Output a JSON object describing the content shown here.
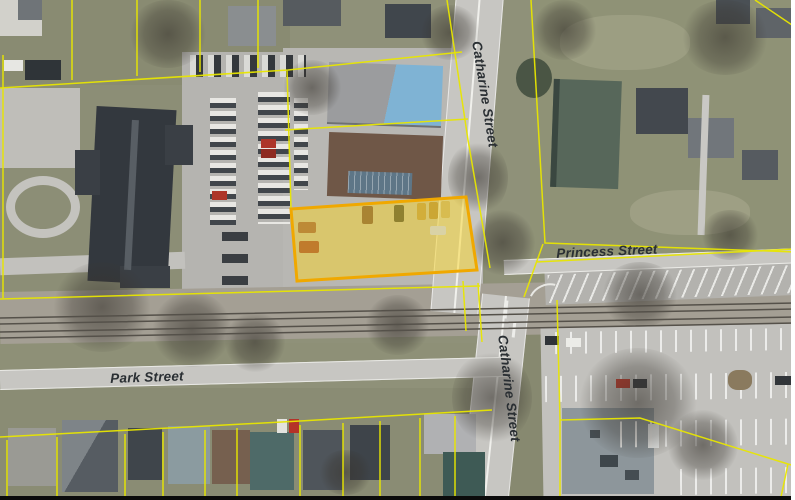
{
  "map": {
    "street_labels": {
      "catharine": "Catharine Street",
      "princess": "Princess Street",
      "park": "Park Street"
    },
    "colors": {
      "parcel_line": "#E8E600",
      "highlight_border": "#F0A800",
      "highlight_fill": "rgba(250,213,40,0.5)",
      "label_text": "#2A2F33"
    }
  }
}
